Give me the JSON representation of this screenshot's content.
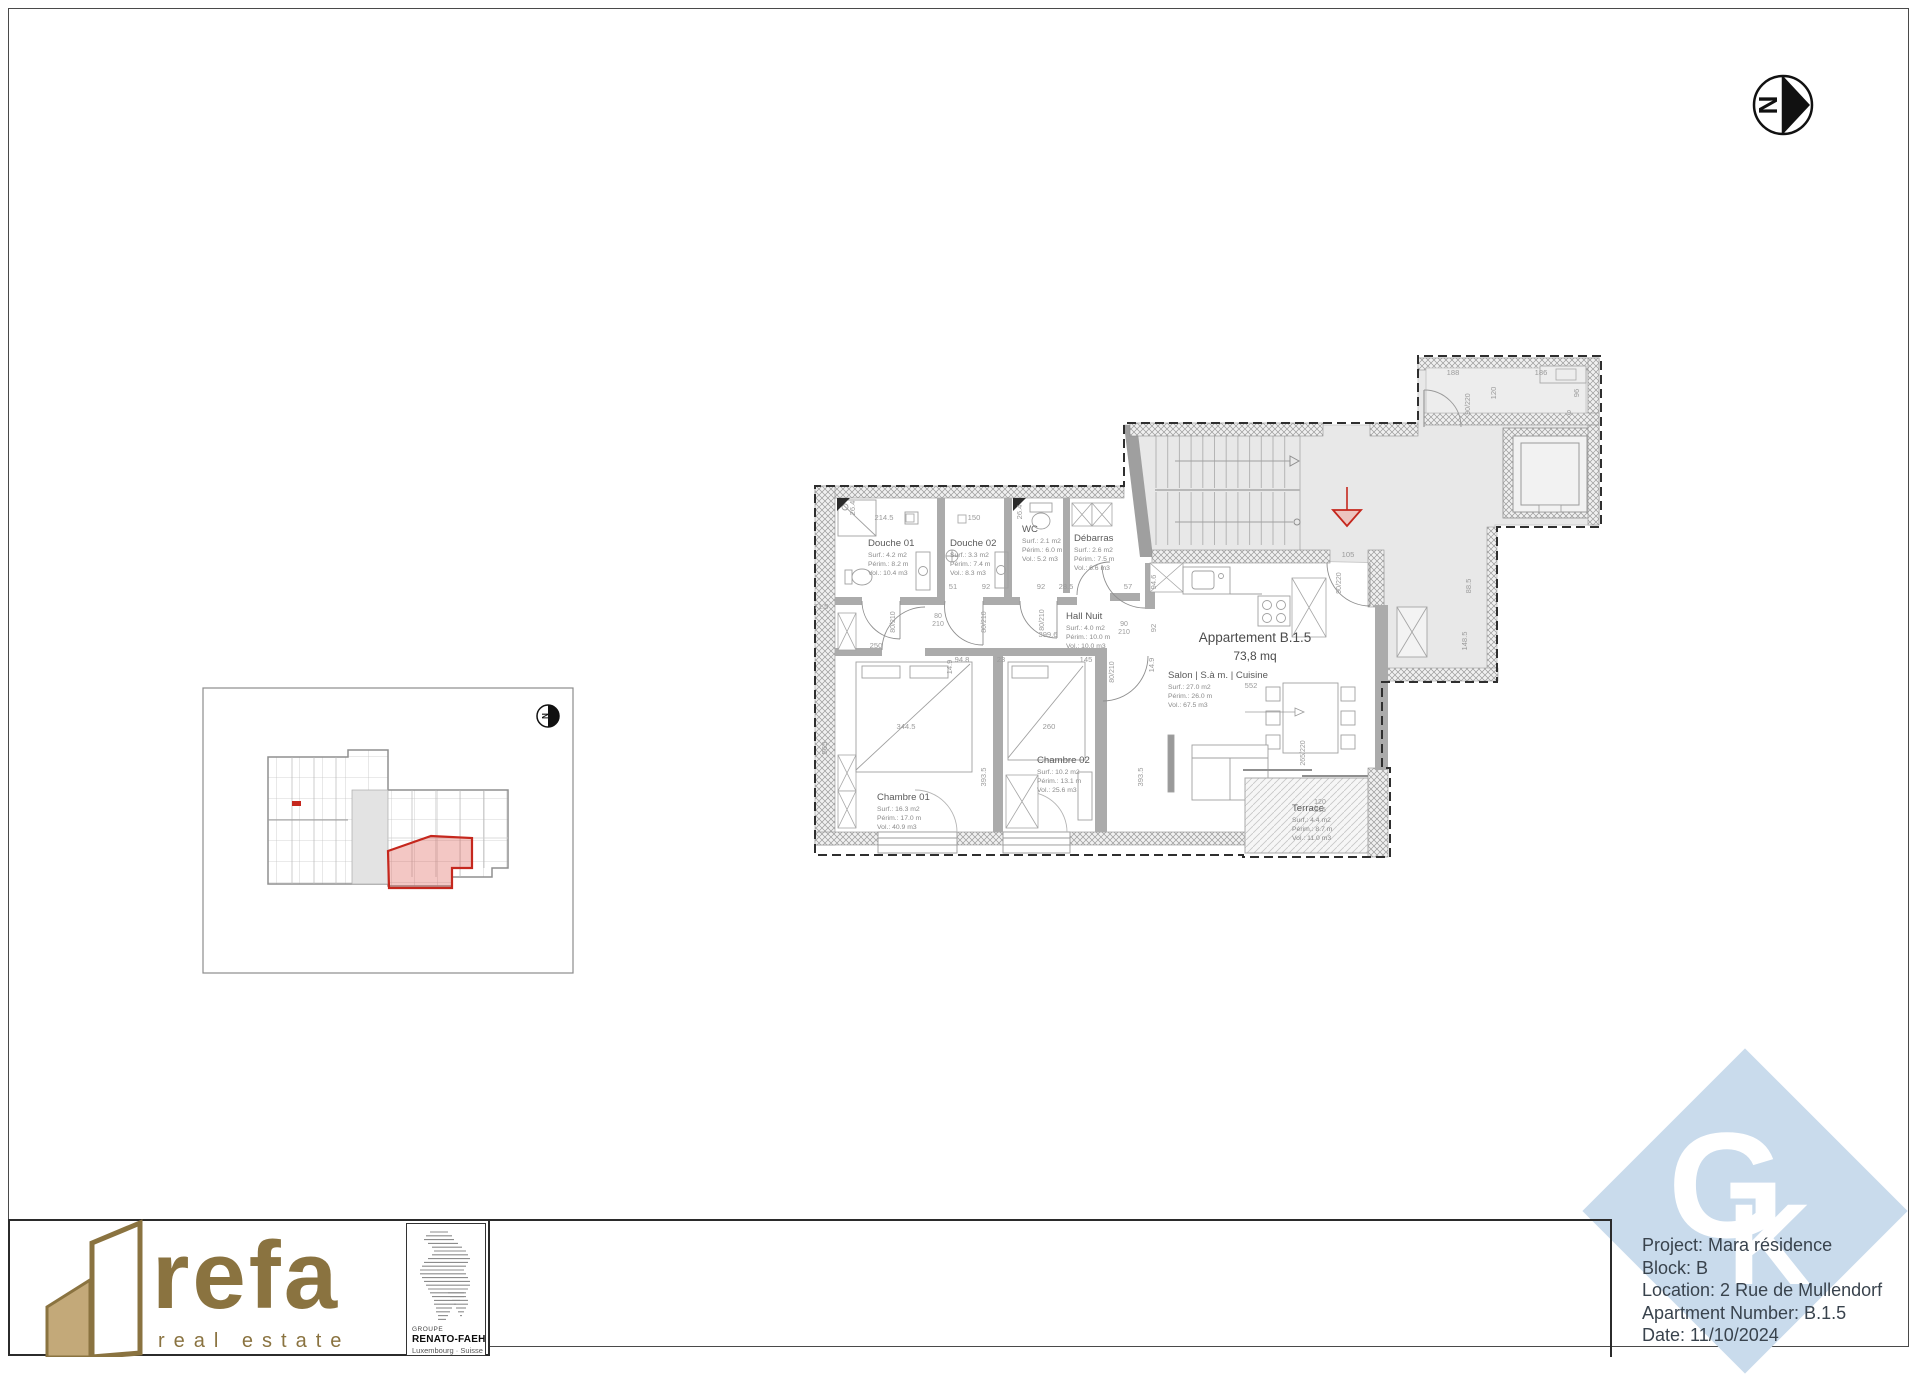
{
  "north_arrow": {
    "label": "N"
  },
  "inset": {
    "north_label": "N"
  },
  "plan": {
    "title": "Appartement B.1.5",
    "area": "73,8 mq",
    "rooms": [
      {
        "name": "Douche 01",
        "surf": "Surf.: 4.2 m2",
        "perim": "Périm.: 8.2 m",
        "vol": "Vol.: 10.4 m3"
      },
      {
        "name": "Douche 02",
        "surf": "Surf.: 3.3 m2",
        "perim": "Périm.: 7.4 m",
        "vol": "Vol.: 8.3 m3"
      },
      {
        "name": "WC",
        "surf": "Surf.: 2.1 m2",
        "perim": "Périm.: 6.0 m",
        "vol": "Vol.: 5.2 m3"
      },
      {
        "name": "Débarras",
        "surf": "Surf.: 2.6 m2",
        "perim": "Périm.: 7.5 m",
        "vol": "Vol.: 6.6 m3"
      },
      {
        "name": "Hall Nuit",
        "surf": "Surf.: 4.0 m2",
        "perim": "Périm.: 10.0 m",
        "vol": "Vol.: 10.0 m3"
      },
      {
        "name": "Chambre 01",
        "surf": "Surf.: 16.3 m2",
        "perim": "Périm.: 17.0 m",
        "vol": "Vol.: 40.9 m3"
      },
      {
        "name": "Chambre 02",
        "surf": "Surf.: 10.2 m2",
        "perim": "Périm.: 13.1 m",
        "vol": "Vol.: 25.6 m3"
      },
      {
        "name": "Salon | S.à m. | Cuisine",
        "surf": "Surf.: 27.0 m2",
        "perim": "Périm.: 26.0 m",
        "vol": "Vol.: 67.5 m3"
      },
      {
        "name": "Terrace",
        "surf": "Surf.: 4.4 m2",
        "perim": "Périm.: 8.7 m",
        "vol": "Vol.: 11.0 m3"
      }
    ],
    "dimensions": [
      "214.5",
      "150",
      "26.4",
      "26.4",
      "71.5",
      "51",
      "92",
      "92",
      "28.5",
      "57",
      "94.6",
      "92",
      "250",
      "399.6",
      "145",
      "23",
      "94.8",
      "14.9",
      "14.9",
      "344.5",
      "260",
      "565",
      "393.5",
      "393.5",
      "552",
      "120",
      "188",
      "186",
      "96",
      "9",
      "88.5",
      "148.5",
      "105"
    ],
    "door_labels": [
      "80/210",
      "80/210",
      "80/210",
      "80/210",
      "90/210",
      "80/210",
      "90/220",
      "90/220",
      "120/215",
      "265/220"
    ],
    "colors": {
      "highlight_red": "#c5271d",
      "common_grey": "#e8e8e8",
      "wall_grey": "#ababab"
    }
  },
  "footer": {
    "refa": {
      "name": "refa",
      "tagline": "real estate",
      "brand_color": "#8a7340"
    },
    "groupe": {
      "label": "GROUPE",
      "name": "RENATO-FAEH",
      "subtitle": "Luxembourg · Suisse"
    },
    "gk": {
      "letter_g": "G",
      "letter_k": "K",
      "diamond_color": "#c9dbec"
    },
    "info": {
      "project": "Project: Mara résidence",
      "block": "Block: B",
      "location": "Location: 2 Rue de Mullendorf",
      "apartment": "Apartment Number: B.1.5",
      "date": "Date: 11/10/2024"
    }
  }
}
